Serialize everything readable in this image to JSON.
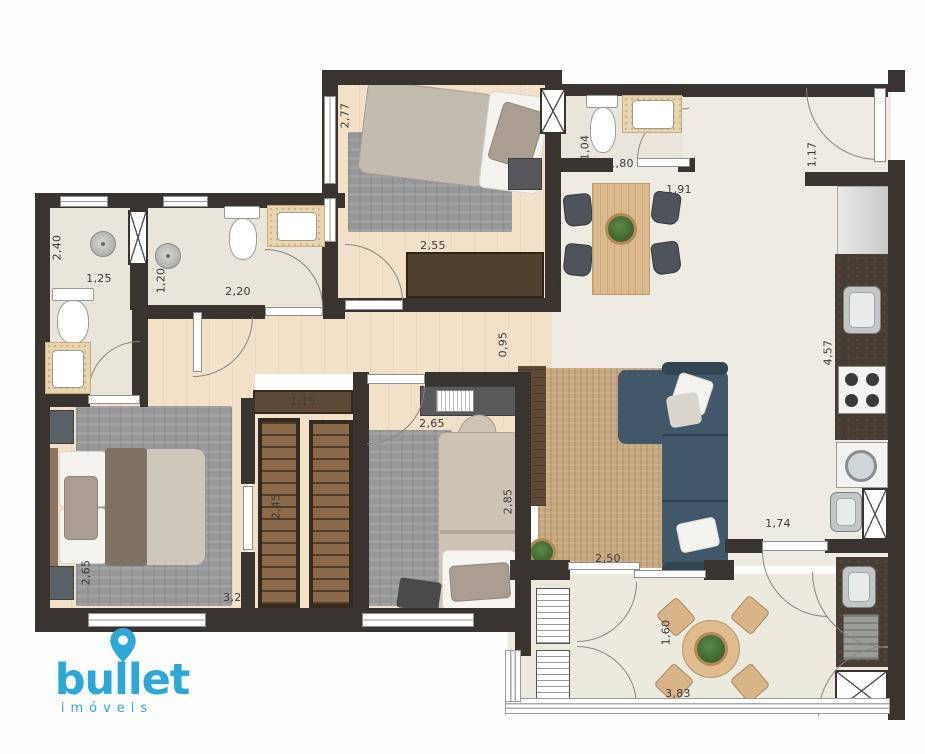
{
  "brand": {
    "name": "bullet",
    "tagline": "imóveis",
    "logo_blue": "#2BA8D8"
  },
  "dimensions_m": [
    "2,77",
    "2,55",
    "1,04",
    "1,80",
    "1,91",
    "1,17",
    "2,40",
    "1,25",
    "1,20",
    "2,20",
    "1,65",
    "0,95",
    "4,57",
    "1,15",
    "2,65",
    "2,85",
    "2,45",
    "2,65",
    "3,22",
    "2,50",
    "1,74",
    "1,60",
    "3,83"
  ],
  "palette": {
    "wall": "#3a3430",
    "bath_floor": "#e9e5da",
    "wood_floor": "#f2e0c9",
    "living_floor": "#edebe2",
    "balcony_floor": "#ece9df",
    "counter_granite": "#473d35",
    "sofa": "#41586a",
    "dining_wood": "#dcba8e",
    "rug_living": "#c8a87e",
    "rug_gray": "#97989a",
    "wardrobe_wood": "#8a6a4a",
    "logo_blue": "#2BA8D8"
  }
}
